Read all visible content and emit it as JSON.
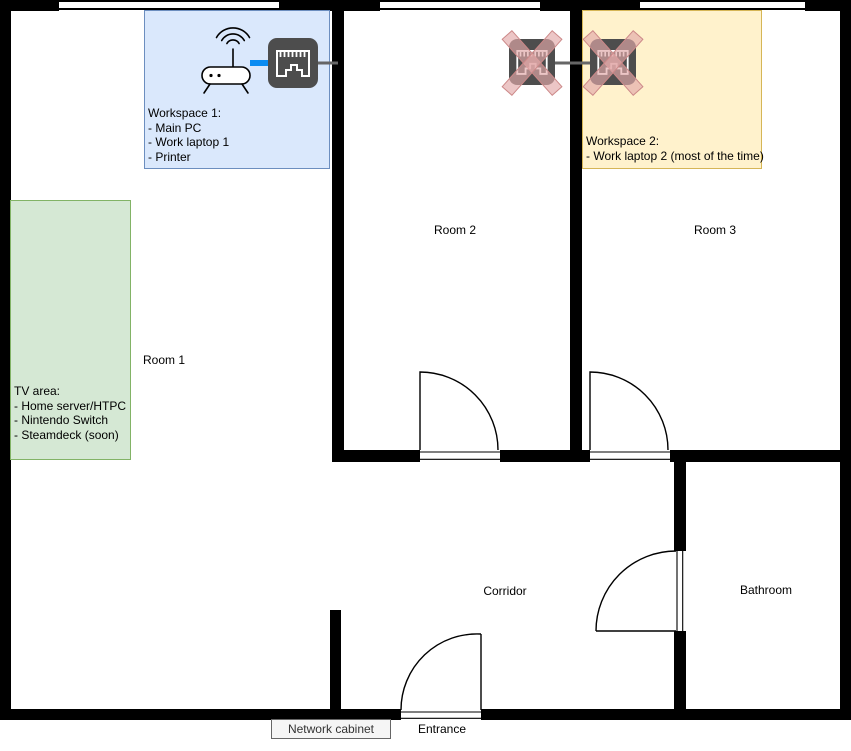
{
  "rooms": {
    "room1": "Room 1",
    "room2": "Room 2",
    "room3": "Room 3",
    "corridor": "Corridor",
    "bathroom": "Bathroom",
    "entrance": "Entrance"
  },
  "annotations": {
    "workspace1": {
      "lines": [
        "Workspace 1:",
        "- Main PC",
        "- Work laptop 1",
        "- Printer"
      ],
      "fill": "#dae8fc",
      "border": "#6c8ebf"
    },
    "workspace2": {
      "lines": [
        "Workspace 2:",
        "- Work laptop 2 (most of the time)"
      ],
      "fill": "#fff2cc",
      "border": "#d6b656"
    },
    "tv_area": {
      "lines": [
        "TV area:",
        "- Home server/HTPC",
        "- Nintendo Switch",
        "- Steamdeck (soon)"
      ],
      "fill": "#d5e8d4",
      "border": "#82b366"
    },
    "network_cabinet": {
      "label": "Network cabinet",
      "fill": "#f5f5f5",
      "border": "#666666"
    }
  },
  "icons": {
    "router": "wifi-router-icon",
    "workspace_port": "ethernet-port-icon",
    "room2_socket": "ethernet-port-crossed-out-icon",
    "room3_socket": "ethernet-port-crossed-out-icon"
  },
  "colors": {
    "wall": "#000000",
    "ethernet_cable": "#0a8cf2",
    "cable_gray": "#666666",
    "port_body": "#4d4d4d",
    "cross_out_stroke": "#cc8888",
    "cross_out_fill": "rgba(226,169,169,0.66)"
  }
}
